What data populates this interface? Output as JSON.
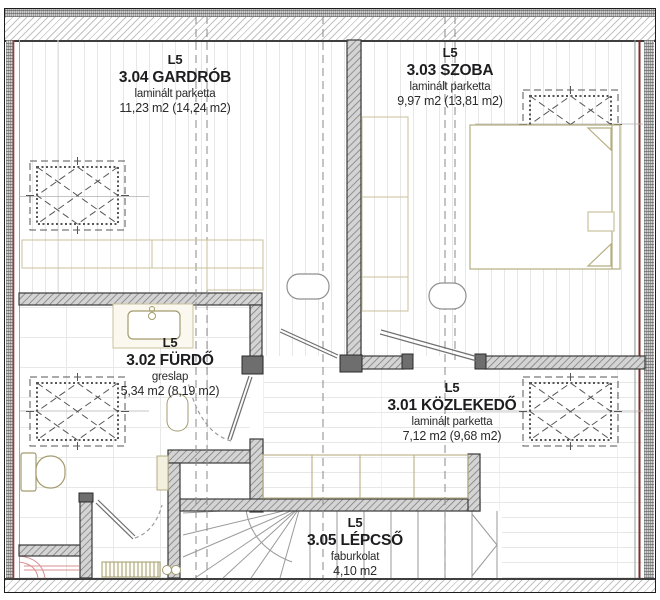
{
  "plan": {
    "level_tag": "L5",
    "rooms": [
      {
        "level": "L5",
        "name": "3.04 GARDRÓB",
        "material": "laminált parketta",
        "area": "11,23 m2 (14,24 m2)"
      },
      {
        "level": "L5",
        "name": "3.03 SZOBA",
        "material": "laminált parketta",
        "area": "9,97 m2 (13,81 m2)"
      },
      {
        "level": "L5",
        "name": "3.02 FÜRDŐ",
        "material": "greslap",
        "area": "5,34 m2 (8,19 m2)"
      },
      {
        "level": "L5",
        "name": "3.01 KÖZLEKEDŐ",
        "material": "laminált parketta",
        "area": "7,12 m2 (9,68 m2)"
      },
      {
        "level": "L5",
        "name": "3.05 LÉPCSŐ",
        "material": "faburkolat",
        "area": "4,10 m2"
      }
    ],
    "colors": {
      "accent_red": "#9e3b3b",
      "dark_red": "#7d2f2f",
      "furniture_olive": "#a39b6e",
      "knee_wall_khaki": "#c9c29b",
      "wall_edge": "#3a3a3a",
      "text": "#1d1d1f"
    }
  }
}
